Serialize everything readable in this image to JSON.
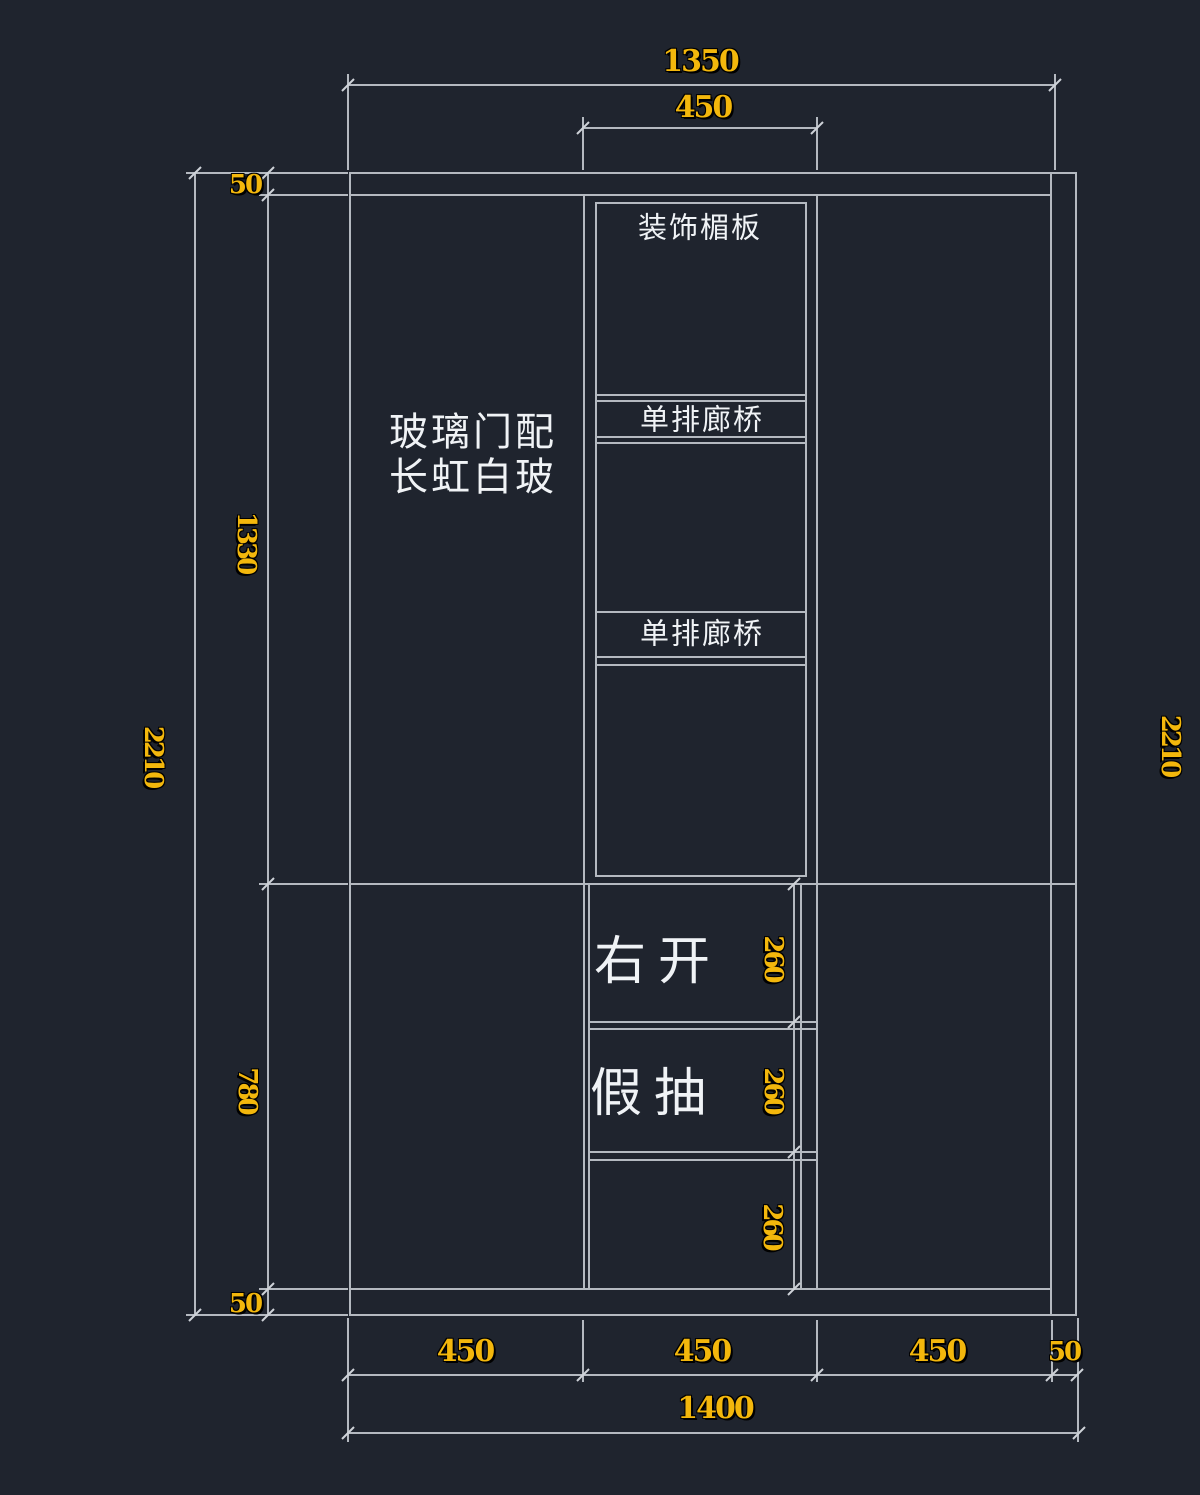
{
  "drawing": {
    "type": "cabinet-elevation-cad-drawing",
    "colors": {
      "background": "#1f242e",
      "outline": "#b4b9c0",
      "dimension_text": "#f3b70c",
      "label_text": "#f0f3f6"
    },
    "labels": {
      "decorative_panel": "装饰楣板",
      "gallery_bridge_1": "单排廊桥",
      "gallery_bridge_2": "单排廊桥",
      "glass_door_line1": "玻璃门配",
      "glass_door_line2": "长虹白玻",
      "right_open": "右开",
      "fake_drawer": "假抽"
    },
    "dims": {
      "top": {
        "overall": "1350",
        "center": "450"
      },
      "left": {
        "top_gap": "50",
        "upper": "1330",
        "overall": "2210",
        "lower": "780",
        "bottom_gap": "50"
      },
      "right": {
        "overall": "2210"
      },
      "middle": {
        "d1": "260",
        "d2": "260",
        "d3": "260"
      },
      "bottom": {
        "s1": "450",
        "s2": "450",
        "s3": "450",
        "s4": "50",
        "overall": "1400"
      }
    }
  }
}
